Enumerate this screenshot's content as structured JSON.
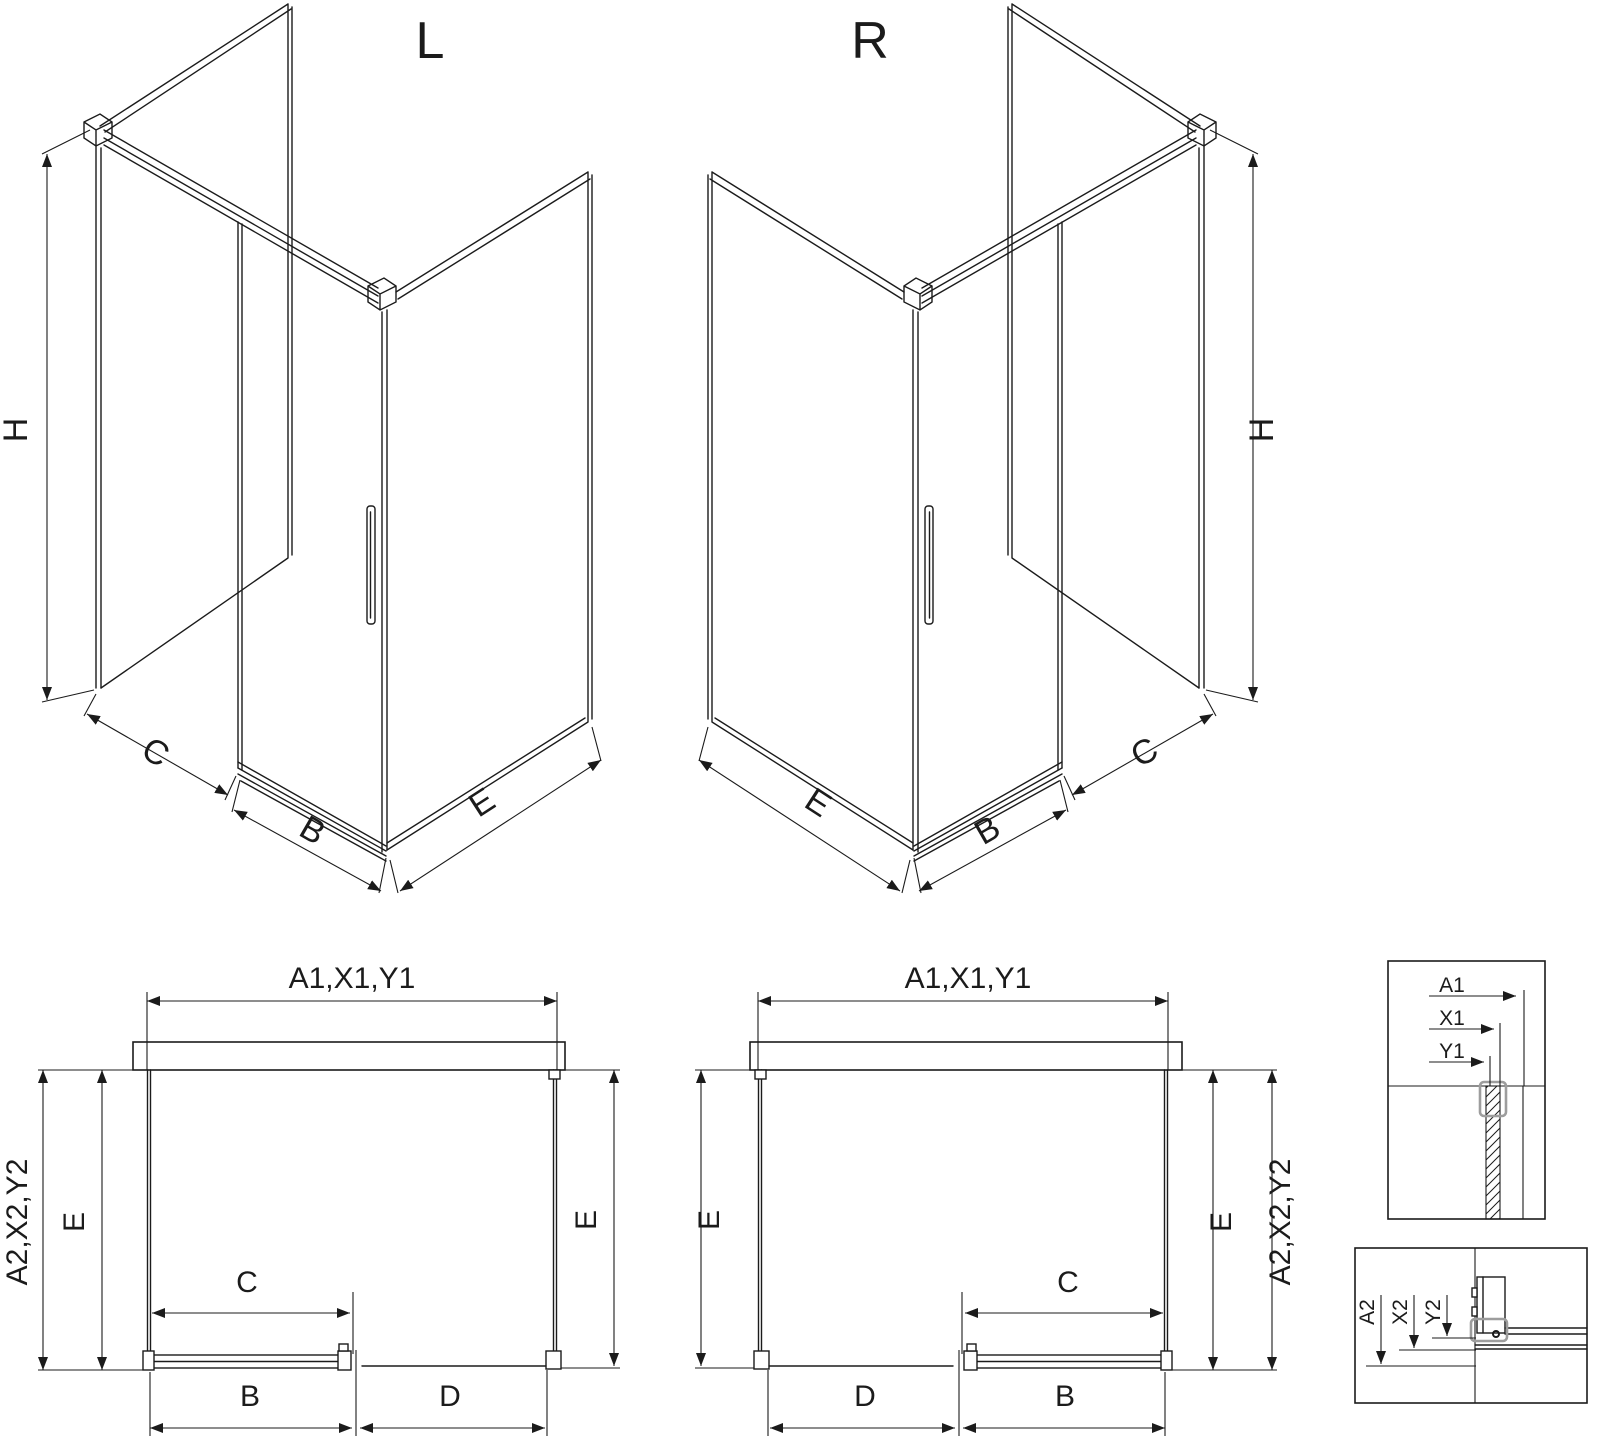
{
  "drawing": {
    "iso_left": {
      "title": "L",
      "dim_height": "H",
      "dim_fixed": "C",
      "dim_door": "B",
      "dim_side": "E"
    },
    "iso_right": {
      "title": "R",
      "dim_height": "H",
      "dim_fixed": "C",
      "dim_door": "B",
      "dim_side": "E"
    },
    "plan_left": {
      "dim_wall_top": "A1,X1,Y1",
      "dim_overall": "A2,X2,Y2",
      "dim_side_left": "E",
      "dim_side_right": "E",
      "dim_fixed": "C",
      "dim_door": "B",
      "dim_opening": "D"
    },
    "plan_right": {
      "dim_wall_top": "A1,X1,Y1",
      "dim_overall": "A2,X2,Y2",
      "dim_side_left": "E",
      "dim_side_right": "E",
      "dim_fixed": "C",
      "dim_door": "B",
      "dim_opening": "D"
    },
    "detail_wall_profile": {
      "dim_1": "A1",
      "dim_2": "X1",
      "dim_3": "Y1"
    },
    "detail_floor_profile": {
      "dim_1": "A2",
      "dim_2": "X2",
      "dim_3": "Y2"
    }
  },
  "colors": {
    "line": "#1b1b1b",
    "detail_label": "#595959",
    "clamp": "#9d9d9d",
    "background": "#ffffff"
  }
}
